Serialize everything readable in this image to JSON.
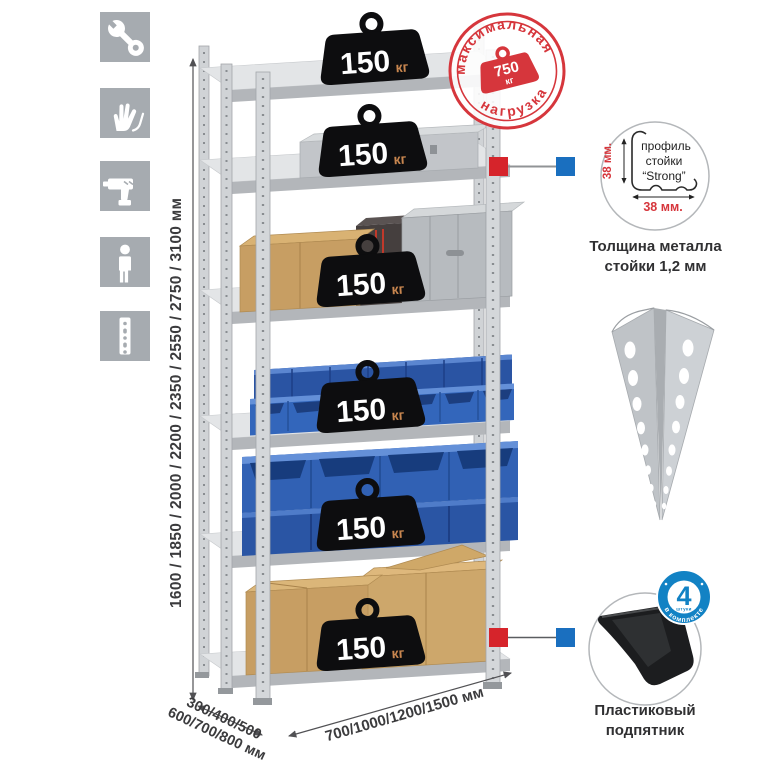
{
  "canvas": {
    "width": 765,
    "height": 765,
    "background": "#ffffff"
  },
  "left_icon_panel": {
    "tile_color": "#a6abb0",
    "icons": [
      {
        "name": "wrench"
      },
      {
        "name": "work-gloves"
      },
      {
        "name": "drill"
      },
      {
        "name": "person"
      },
      {
        "name": "perforated-upright"
      }
    ]
  },
  "height_dimension": {
    "label": "1600 / 1850 / 2000 / 2200 / 2350 / 2550 / 2750 / 3100 мм"
  },
  "depth_dimension": {
    "line1": "300/400/500",
    "line2": "600/700/800 мм"
  },
  "width_dimension": {
    "label": "700/1000/1200/1500 мм"
  },
  "shelf_weights": [
    {
      "value": "150",
      "unit": "кг"
    },
    {
      "value": "150",
      "unit": "кг"
    },
    {
      "value": "150",
      "unit": "кг"
    },
    {
      "value": "150",
      "unit": "кг"
    },
    {
      "value": "150",
      "unit": "кг"
    },
    {
      "value": "150",
      "unit": "кг"
    }
  ],
  "max_load_stamp": {
    "arc_top": "максимальная",
    "arc_bottom": "нагрузка",
    "value": "750",
    "unit": "кг",
    "color": "#d6363c"
  },
  "profile_detail": {
    "label_line1": "профиль",
    "label_line2": "стойки",
    "label_line3": "“Strong”",
    "dim_vertical": "38 мм.",
    "dim_horizontal": "38 мм.",
    "caption_line1": "Толщина металла",
    "caption_line2": "стойки 1,2 мм"
  },
  "corner_post": {
    "name": "perforated-angle-profile"
  },
  "foot_detail": {
    "badge_value": "4",
    "badge_small_text": "штуки",
    "badge_ring_text": "в комплекте",
    "badge_color": "#1282c4",
    "caption_line1": "Пластиковый",
    "caption_line2": "подпятник"
  },
  "connector_colors": {
    "red": "#d6242b",
    "blue": "#1a6fbf"
  }
}
